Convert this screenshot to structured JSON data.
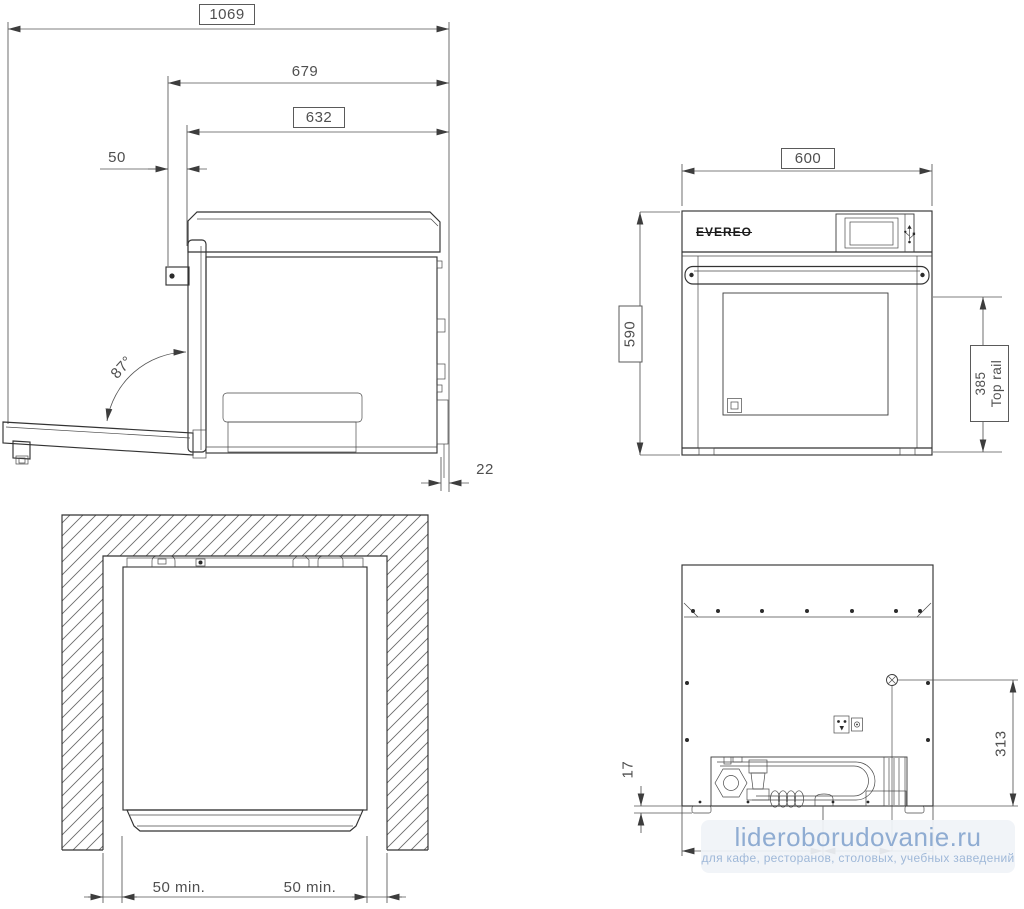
{
  "side_view": {
    "overall_depth_door_open": "1069",
    "depth_with_door": "679",
    "body_depth": "632",
    "front_offset": "50",
    "door_open_angle": "87°",
    "rear_gap": "22"
  },
  "front_view": {
    "width": "600",
    "height": "590",
    "top_rail_value": "385",
    "top_rail_label": "Top rail",
    "logo": "EVEREO"
  },
  "top_view": {
    "left_clearance": "50 min.",
    "right_clearance": "50 min."
  },
  "back_view": {
    "base_gap": "17",
    "connector_height": "313"
  },
  "watermark": {
    "site": "lideroborudovanie.ru",
    "tagline": "для кафе, ресторанов, столовых, учебных заведений"
  },
  "colors": {
    "line": "#333333",
    "dimension": "#4f4f4f",
    "watermark_text": "#8facd2",
    "watermark_tagline": "#9fb8d8",
    "watermark_bg": "#f0f3f7"
  }
}
